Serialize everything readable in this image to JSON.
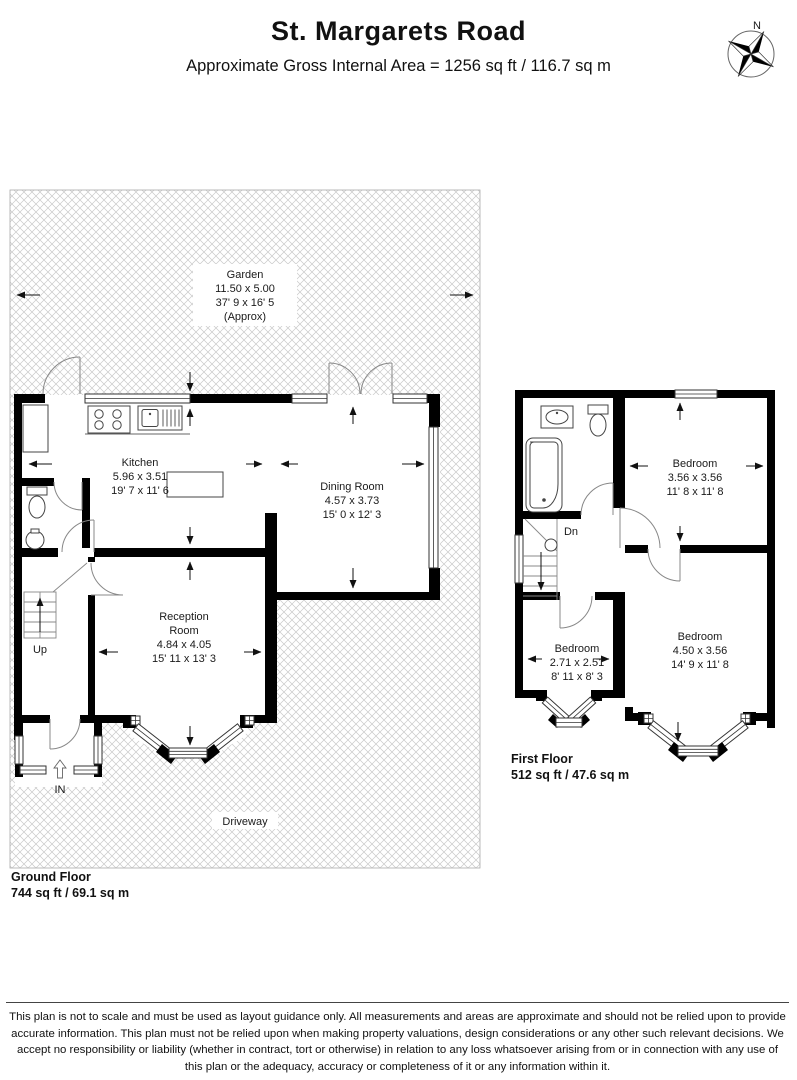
{
  "header": {
    "title": "St. Margarets Road",
    "subtitle": "Approximate Gross Internal Area = 1256 sq ft / 116.7 sq m"
  },
  "compass": {
    "n": "N"
  },
  "gf": {
    "garden": {
      "l1": "Garden",
      "l2": "11.50 x 5.00",
      "l3": "37' 9 x 16' 5",
      "l4": "(Approx)"
    },
    "kitchen": {
      "l1": "Kitchen",
      "l2": "5.96 x 3.51",
      "l3": "19' 7 x 11' 6"
    },
    "dining": {
      "l1": "Dining Room",
      "l2": "4.57 x 3.73",
      "l3": "15' 0 x 12' 3"
    },
    "reception": {
      "l1": "Reception",
      "l2": "Room",
      "l3": "4.84 x 4.05",
      "l4": "15' 11 x 13' 3"
    },
    "driveway": "Driveway",
    "up": "Up",
    "in_label": "IN",
    "floor_label": "Ground Floor",
    "floor_area": "744 sq ft / 69.1 sq m"
  },
  "ff": {
    "bed1": {
      "l1": "Bedroom",
      "l2": "3.56 x 3.56",
      "l3": "11' 8 x 11' 8"
    },
    "bed2": {
      "l1": "Bedroom",
      "l2": "2.71 x 2.51",
      "l3": "8' 11 x 8' 3"
    },
    "bed3": {
      "l1": "Bedroom",
      "l2": "4.50 x 3.56",
      "l3": "14' 9 x 11' 8"
    },
    "dn": "Dn",
    "floor_label": "First Floor",
    "floor_area": "512 sq ft / 47.6 sq m"
  },
  "disclaimer": "This plan is not to scale and must be used as layout guidance only. All measurements and areas are approximate and should not be relied upon to provide accurate information. This plan must not be relied upon when making property valuations, design considerations or any other such relevant decisions. We accept no responsibility or liability (whether in contract, tort or otherwise) in relation to any loss whatsoever arising from or in connection with any use of this plan or the adequacy, accuracy or completeness of it or any information within it."
}
